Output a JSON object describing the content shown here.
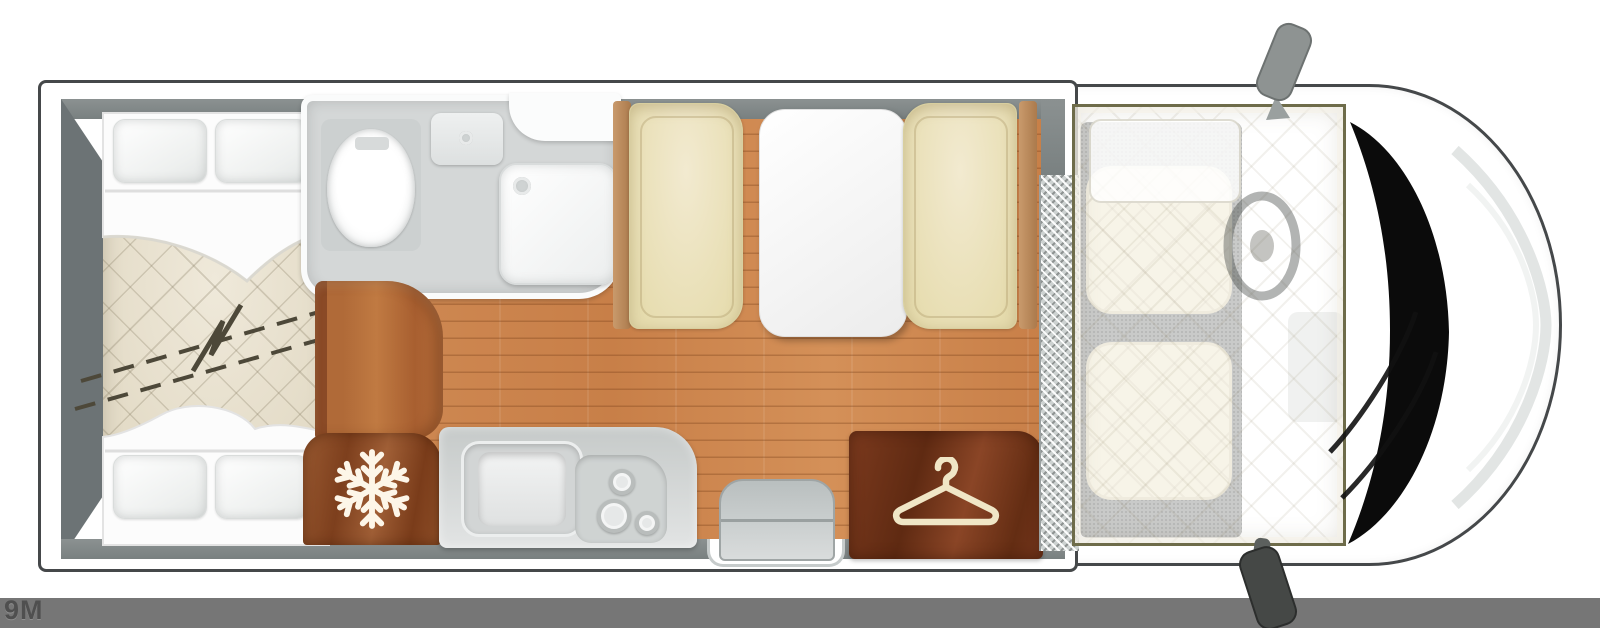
{
  "footer": {
    "model_label": "9M"
  },
  "colors": {
    "page_bg": "#ffffff",
    "footer_bar": "#767676",
    "footer_text": "#4f4f4f",
    "outline": "#45484a",
    "wall": "#8b9191",
    "wall_dark": "#6c7375",
    "wood_floor": "#cd8550",
    "quilt": "#e8e2d1",
    "cushion": "#e6dcae",
    "bathroom_floor": "#d4d7d7",
    "kitchen_unit": "#c6cac9",
    "cab_carpet": "#8f918f",
    "checker_plate": "#cdd2d1",
    "dropdown_bed_border": "#6e6c4a",
    "windshield": "#0b0b0b",
    "fridge_wood": "#8a4a26",
    "wardrobe_wood": "#6f3318"
  },
  "icons": [
    {
      "name": "snowflake-icon",
      "represents": "fridge"
    },
    {
      "name": "hanger-icon",
      "represents": "wardrobe"
    }
  ],
  "floorplan": {
    "type": "motorhome overhead floor plan",
    "areas": [
      "rear-twin-beds",
      "washroom",
      "dinette",
      "kitchen",
      "fridge",
      "wardrobe",
      "entrance-step",
      "drop-down-bed",
      "cab"
    ]
  }
}
